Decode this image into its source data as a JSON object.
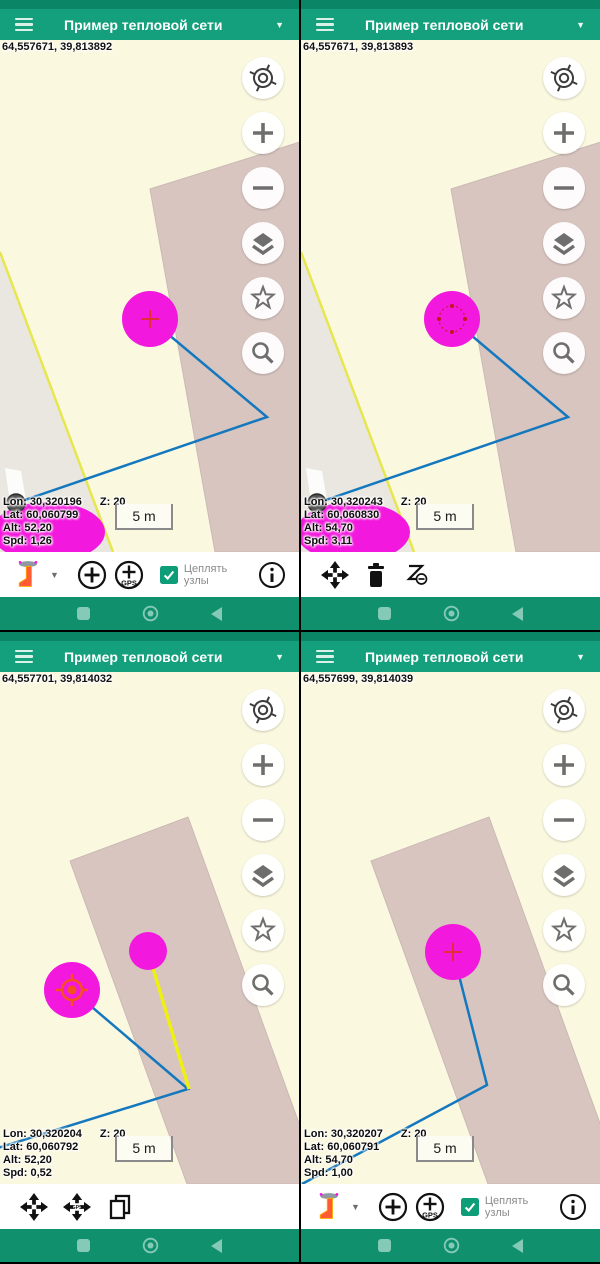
{
  "app": {
    "nav_square": "recents",
    "nav_circle": "home",
    "nav_triangle": "back",
    "caret_char": "▼"
  },
  "colors": {
    "appbar": "#14a07c",
    "statusbar": "#0a8566",
    "navbar": "#11906e",
    "nav_icon": "#84cab6",
    "map_bg": "#fbf8e0",
    "building": "#d8c5c0",
    "line_blue": "#1478be",
    "line_yellow": "#eef011",
    "node_magenta": "#f318dd",
    "marker_red": "#e03222",
    "gps_orange": "#f4511e",
    "checkbox_green": "#0e9d79"
  },
  "quadrants": [
    {
      "title": "Пример тепловой сети",
      "coords": "64,557671, 39,813892",
      "scale_label": "5 m",
      "info": {
        "lon": "Lon: 30,320196",
        "z": "Z: 20",
        "lat": "Lat: 60,060799",
        "alt": "Alt: 52,20",
        "spd": "Spd: 1,26"
      },
      "toolbar": {
        "type": "draw",
        "snap_line1": "Цеплять",
        "snap_line2": "узлы"
      },
      "map": {
        "bg": "#fbf8e0",
        "polygons": [
          {
            "name": "roadside-area",
            "points": "0,212 113,512 0,512",
            "fill": "#eae6e0"
          },
          {
            "name": "road-stripe",
            "points": "5,428 21,431 35,512 17,512",
            "fill": "#fcfcfa"
          },
          {
            "name": "building",
            "points": "150,149 300,102 300,512 215,512",
            "fill": "#d8c5c0",
            "stroke": "#cbb9b4"
          }
        ],
        "polylines": [
          {
            "name": "parcel-edge",
            "points": "0,212 113,512",
            "color": "#e6e74f",
            "width": 2.5
          },
          {
            "name": "pipe-line",
            "points": "150,279 267,377 16,463",
            "color": "#1478be",
            "width": 2.5
          }
        ],
        "shapes": [
          {
            "name": "speed-blob",
            "cx": 48,
            "cy": 492,
            "rx": 57,
            "ry": 30,
            "fill": "#f318dd"
          },
          {
            "name": "gray-point",
            "cx": 16,
            "cy": 463,
            "rx": 9,
            "ry": 9,
            "fill": "#4e4e4e",
            "stroke": "#2e2e2e",
            "sw": 1.5
          },
          {
            "name": "node-circle",
            "cx": 150,
            "cy": 279,
            "rx": 28,
            "ry": 28,
            "fill": "#f318dd"
          }
        ],
        "markers": [
          {
            "type": "cross",
            "cx": 150,
            "cy": 279,
            "color": "#e03222"
          }
        ]
      }
    },
    {
      "title": "Пример тепловой сети",
      "coords": "64,557671, 39,813893",
      "scale_label": "5 m",
      "info": {
        "lon": "Lon: 30,320243",
        "z": "Z: 20",
        "lat": "Lat: 60,060830",
        "alt": "Alt: 54,70",
        "spd": "Spd: 3,11"
      },
      "toolbar": {
        "type": "selection"
      },
      "map": {
        "bg": "#fbf8e0",
        "polygons": [
          {
            "name": "roadside-area",
            "points": "0,212 113,512 0,512",
            "fill": "#eae6e0"
          },
          {
            "name": "road-stripe",
            "points": "5,428 21,431 35,512 17,512",
            "fill": "#fcfcfa"
          },
          {
            "name": "building",
            "points": "150,149 300,102 300,512 215,512",
            "fill": "#d8c5c0",
            "stroke": "#cbb9b4"
          }
        ],
        "polylines": [
          {
            "name": "parcel-edge",
            "points": "0,212 113,512",
            "color": "#e6e74f",
            "width": 2.5
          },
          {
            "name": "pipe-line",
            "points": "151,279 267,377 16,463",
            "color": "#1478be",
            "width": 2.5
          }
        ],
        "shapes": [
          {
            "name": "speed-blob",
            "cx": 52,
            "cy": 492,
            "rx": 57,
            "ry": 30,
            "fill": "#f318dd"
          },
          {
            "name": "gray-point",
            "cx": 16,
            "cy": 463,
            "rx": 9,
            "ry": 9,
            "fill": "#4e4e4e",
            "stroke": "#2e2e2e",
            "sw": 1.5
          },
          {
            "name": "node-circle",
            "cx": 151,
            "cy": 279,
            "rx": 28,
            "ry": 28,
            "fill": "#f318dd"
          }
        ],
        "markers": [
          {
            "type": "handles",
            "cx": 151,
            "cy": 279,
            "color": "#c41616"
          }
        ]
      }
    },
    {
      "title": "Пример тепловой сети",
      "coords": "64,557701, 39,814032",
      "scale_label": "5 m",
      "info": {
        "lon": "Lon: 30,320204",
        "z": "Z: 20",
        "lat": "Lat: 60,060792",
        "alt": "Alt: 52,20",
        "spd": "Spd: 0,52"
      },
      "toolbar": {
        "type": "move"
      },
      "map": {
        "bg": "#fbf8e0",
        "polygons": [
          {
            "name": "building",
            "points": "70,189 188,145 300,454 300,512 187,512",
            "fill": "#d8c5c0",
            "stroke": "#cbb9b4"
          }
        ],
        "polylines": [
          {
            "name": "pipe-line",
            "points": "72,318 188,417 -12,479",
            "color": "#1478be",
            "width": 2.5
          },
          {
            "name": "new-segment",
            "points": "148,279 189,417",
            "color": "#eef011",
            "width": 3.5
          }
        ],
        "shapes": [
          {
            "name": "node-circle-large",
            "cx": 72,
            "cy": 318,
            "rx": 28,
            "ry": 28,
            "fill": "#f318dd"
          },
          {
            "name": "node-circle-small",
            "cx": 148,
            "cy": 279,
            "rx": 19,
            "ry": 19,
            "fill": "#f318dd"
          }
        ],
        "markers": [
          {
            "type": "gps-target",
            "cx": 72,
            "cy": 318,
            "color": "#f4511e"
          }
        ]
      }
    },
    {
      "title": "Пример тепловой сети",
      "coords": "64,557699, 39,814039",
      "scale_label": "5 m",
      "info": {
        "lon": "Lon: 30,320207",
        "z": "Z: 20",
        "lat": "Lat: 60,060791",
        "alt": "Alt: 54,70",
        "spd": "Spd: 1,00"
      },
      "toolbar": {
        "type": "draw",
        "snap_line1": "Цеплять",
        "snap_line2": "узлы"
      },
      "map": {
        "bg": "#fbf8e0",
        "polygons": [
          {
            "name": "building",
            "points": "70,189 188,145 300,454 300,512 187,512",
            "fill": "#d8c5c0",
            "stroke": "#cbb9b4"
          }
        ],
        "polylines": [
          {
            "name": "pipe-line",
            "points": "152,280 186,413 1,512",
            "color": "#1478be",
            "width": 2.5
          }
        ],
        "shapes": [
          {
            "name": "node-circle",
            "cx": 152,
            "cy": 280,
            "rx": 28,
            "ry": 28,
            "fill": "#f318dd"
          }
        ],
        "markers": [
          {
            "type": "cross",
            "cx": 152,
            "cy": 280,
            "color": "#e03222"
          }
        ]
      }
    }
  ]
}
